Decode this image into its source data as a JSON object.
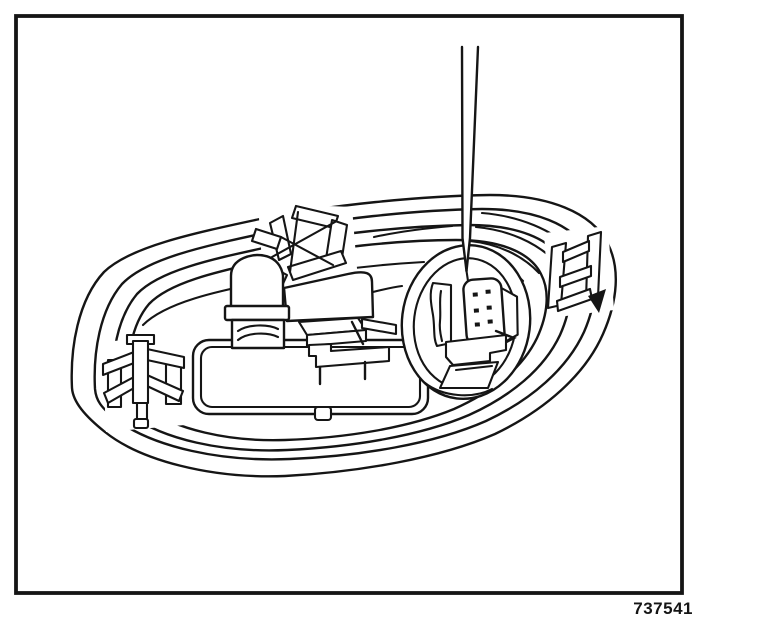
{
  "figure": {
    "number": "737541"
  },
  "colors": {
    "background": "#ffffff",
    "ink": "#151515"
  },
  "parts": {
    "frame": "illustration-border",
    "housing": "oval-lamp-housing-with-concentric-bezel-ridges",
    "clip_left": "left-retaining-clip",
    "clip_top": "top-retaining-clip",
    "clip_right": "right-retaining-clip",
    "platform": "lamp-base-platform",
    "bulb": "lamp-bulb-and-socket",
    "switch": "switch-assembly",
    "recess": "connector-recess",
    "connector": "wiring-connector-block",
    "tool": "screwdriver-blade"
  }
}
